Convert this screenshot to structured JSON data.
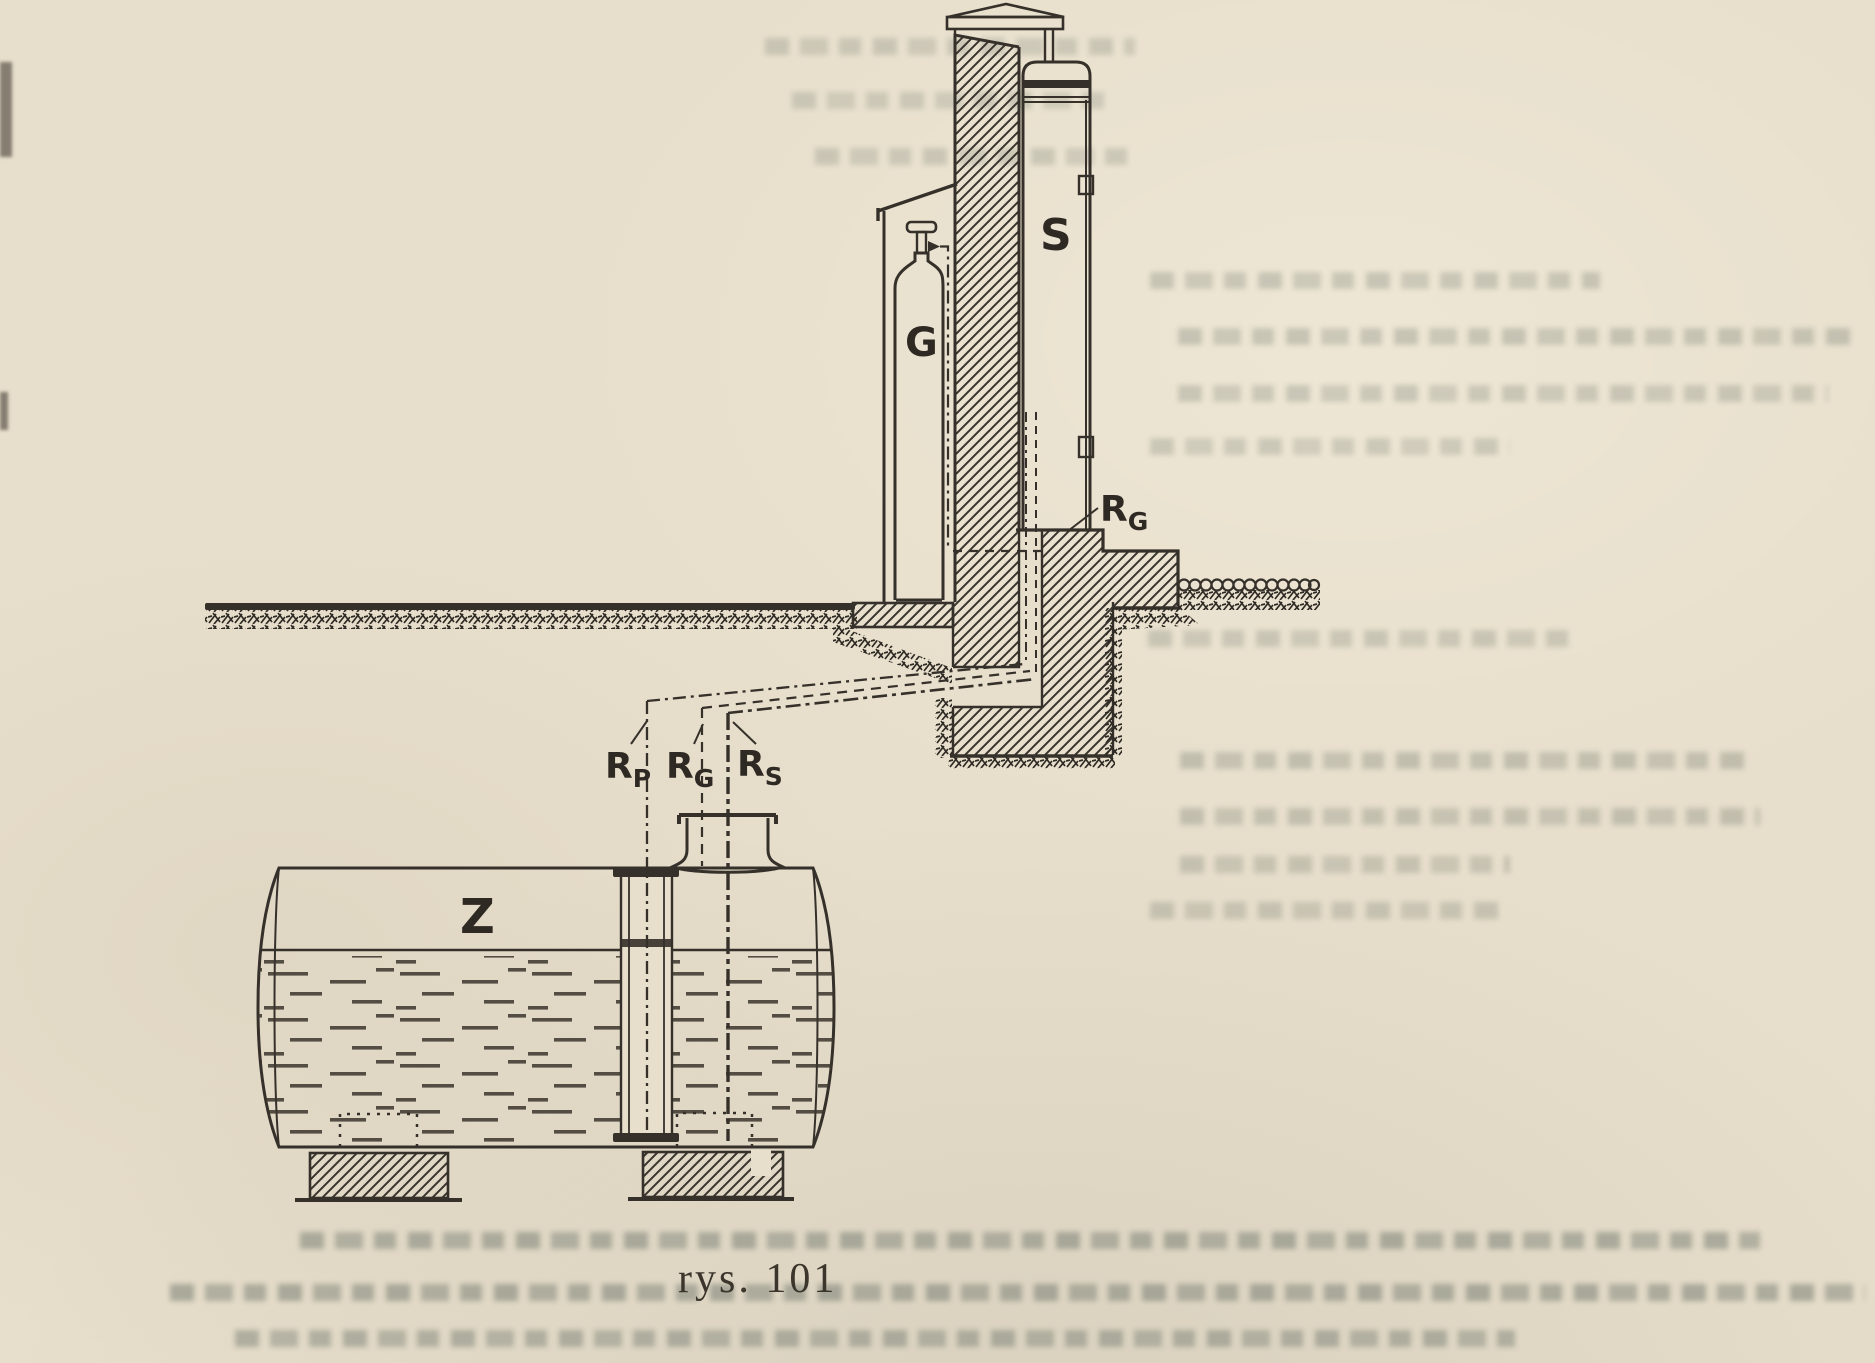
{
  "figure": {
    "caption": "rys. 101",
    "labels": {
      "tank": "Z",
      "dispenser": "S",
      "gas_cylinder": "G",
      "pipe_p": {
        "main": "R",
        "sub": "P"
      },
      "pipe_g": {
        "main": "R",
        "sub": "G"
      },
      "pipe_s": {
        "main": "R",
        "sub": "S"
      },
      "pipe_g_at_foundation": {
        "main": "R",
        "sub": "G"
      }
    },
    "colors": {
      "paper": "#e7decb",
      "ink": "#35302a"
    }
  }
}
